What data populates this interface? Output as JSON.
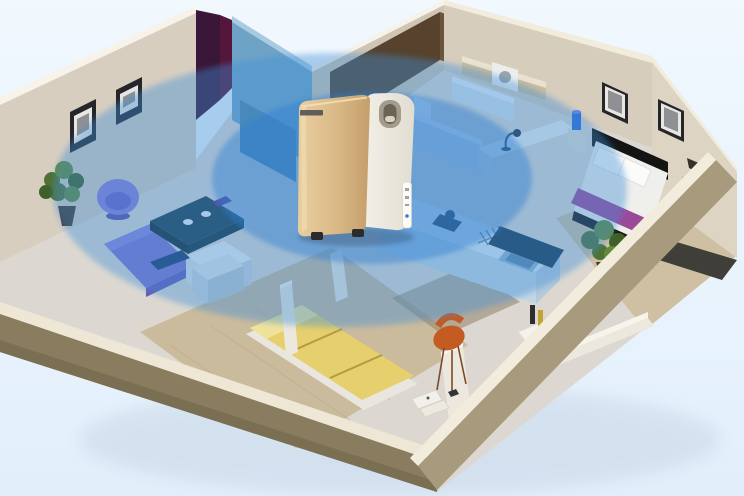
{
  "scene": {
    "kind": "isometric-apartment-cutaway-render",
    "overlay": "air-circulation-coverage-zones",
    "device": "air-purifier"
  },
  "coverage": {
    "outer_opacity": 0.4,
    "inner_opacity": 0.42
  },
  "rooms": {
    "living_room": {
      "furniture": [
        "round-armchair",
        "chaise-sofa",
        "coffee-table",
        "sideboard",
        "floor-plant",
        "wall-pictures",
        "rug"
      ]
    },
    "bathroom": {
      "furniture": [
        "toilet",
        "vanity",
        "wall-shelf",
        "washing-machine"
      ]
    },
    "study_nook": {
      "furniture": [
        "desk",
        "desk-lamp"
      ]
    },
    "kitchen": {
      "furniture": [
        "counter",
        "sink",
        "dish-rack",
        "stove-pot",
        "bar-counter",
        "floor-plant"
      ]
    },
    "master_bedroom": {
      "furniture": [
        "double-bed",
        "pillows",
        "bed-runner",
        "nightstands",
        "table-lamps",
        "wall-pictures",
        "rug"
      ]
    },
    "second_bedroom": {
      "furniture": [
        "yellow-bed",
        "nightstand",
        "media-unit"
      ]
    },
    "hallway": {
      "furniture": [
        "orange-chair",
        "books-on-floor",
        "drinks-tray"
      ]
    }
  },
  "colors": {
    "bg_top": "#f1f8fe",
    "bg_bottom": "#e2effb",
    "ground_shadow": "#9fb0c6",
    "floor_base": "#dcd8d1",
    "floor_wood": "#cbbb9d",
    "floor_wood_master": "#cfc0a4",
    "floor_tile": "#94846c",
    "rug_master": "#403e39",
    "rug_living": "#dad8d4",
    "plank_line": "#b9a888",
    "wall_cream": "#d7cec0",
    "wall_cream_dark": "#cfc5b4",
    "wall_cream_right": "#d6cdbd",
    "wall_side_inner": "#ddd4c4",
    "ridge_white": "#f7f3ea",
    "ridge_warm": "#f2ecdd",
    "accent_purple": "#3a1638",
    "accent_maroon": "#54163a",
    "glass_teal": "#6fa3c6",
    "glass_teal_top": "#a8cbe2",
    "cabinet_blue": "#4f86ab",
    "tile_brown_dark": "#56422d",
    "tile_brown": "#6d5539",
    "shelf_top": "#e9e2d0",
    "shelf_face": "#cbbd9e",
    "washer_white": "#eceeee",
    "washer_door": "#9aa4ac",
    "frame_dark": "#26262a",
    "frame_mat": "#e9e7e2",
    "frame_photo": "#8f9093",
    "toilet_white": "#eef1f2",
    "toilet_shadow": "#c9d3d8",
    "lowwall_top": "#e6edf2",
    "lowwall_face": "#ccd8e2",
    "vanity_top": "#e8f0f6",
    "vanity_front": "#d6e2ec",
    "desk_top": "#eef0ee",
    "desk_front": "#d8dcd8",
    "lamp_navy": "#23364f",
    "bedside_cream": "#e2ddd0",
    "bedside_dark": "#c4b9a6",
    "lamp_blue": "#2f6bd6",
    "lamp_blue_top": "#5b8ae6",
    "lamp_shade_dark": "#35322c",
    "headboard_black": "#141414",
    "mattress_white": "#efefec",
    "pillow_white": "#fbfbf9",
    "runner_magenta": "#9b4a9a",
    "footboard_black": "#171717",
    "nightstand_top": "#e4e7ea",
    "nightstand_front": "#cfd5da",
    "nightstand_side": "#bfc7cf",
    "tv_navy": "#1d3a6b",
    "bed_yellow": "#e6cf6d",
    "bed_yellow_light": "#efe29a",
    "bed_base_white": "#e9e6df",
    "bed_seam": "#b49a42",
    "partition_face": "#ece8dd",
    "partition_top": "#f7f4ec",
    "counter_top": "#dce9f1",
    "counter_front": "#c3d6e4",
    "counter_side": "#b4c9da",
    "bar_navy": "#1c3a55",
    "sink_light": "#8fb5d0",
    "sink_dark": "#5e87a8",
    "stove_dark": "#26323e",
    "dishrack": "#6e8296",
    "faucet": "#9aa8b4",
    "plant_green": "#4e7231",
    "plant_green_light": "#628a3b",
    "plant_green_dark": "#3f6128",
    "pot_dark": "#433a30",
    "chair_purple": "#8a7ed9",
    "chair_purple_dark": "#6c60c8",
    "chair_purple_base": "#5a50a8",
    "sofa_purple": "#7b73cf",
    "sofa_purple_light": "#8d85dd",
    "sofa_purple_dark": "#645cb8",
    "table_teal": "#1f3f4e",
    "table_teal_dark": "#142c38",
    "table_teal_side": "#173443",
    "cup_white": "#eef2f8",
    "flower_purple": "#5c2f86",
    "sideboard_top": "#f0f2f4",
    "sideboard_front": "#dde2e7",
    "sideboard_side": "#ccd3da",
    "chair_orange": "#c35b22",
    "chair_leg": "#7d4a28",
    "book_white": "#f2f0ea",
    "book_white2": "#eceade",
    "book_dark": "#333538",
    "tray_white": "#f4f2ec",
    "bottle_dark": "#2e2e30",
    "bottle_yellow": "#c3a133",
    "cup_blue": "#4a6cc8",
    "band_top_left": "#efe7d6",
    "band_tan_left": "#897c5f",
    "band_tan_left_dark": "#7a6e53",
    "band_tan_right": "#a89a7d",
    "band_ridge_right": "#f2ecdc",
    "coverage_outer": "#3e8ed8",
    "coverage_inner": "#2e7ed2",
    "gold_light": "#e9cf9e",
    "gold_mid": "#d9b886",
    "gold_dark": "#c49e6b",
    "gold_sheen": "#f4e2bb",
    "white_light": "#f3f0e9",
    "white_dark": "#e2ddd1",
    "handle_ring": "#a39c8d",
    "handle_hole": "#6b6356",
    "handle_glint": "#d9d4c6",
    "logo_dark": "#4a4a52",
    "strip_white": "#fbfaf5",
    "strip_mark": "#9aa2ae",
    "strip_dot": "#3a78d0",
    "foot_dark": "#2b2b2b",
    "device_shadow": "#2a3c55"
  }
}
